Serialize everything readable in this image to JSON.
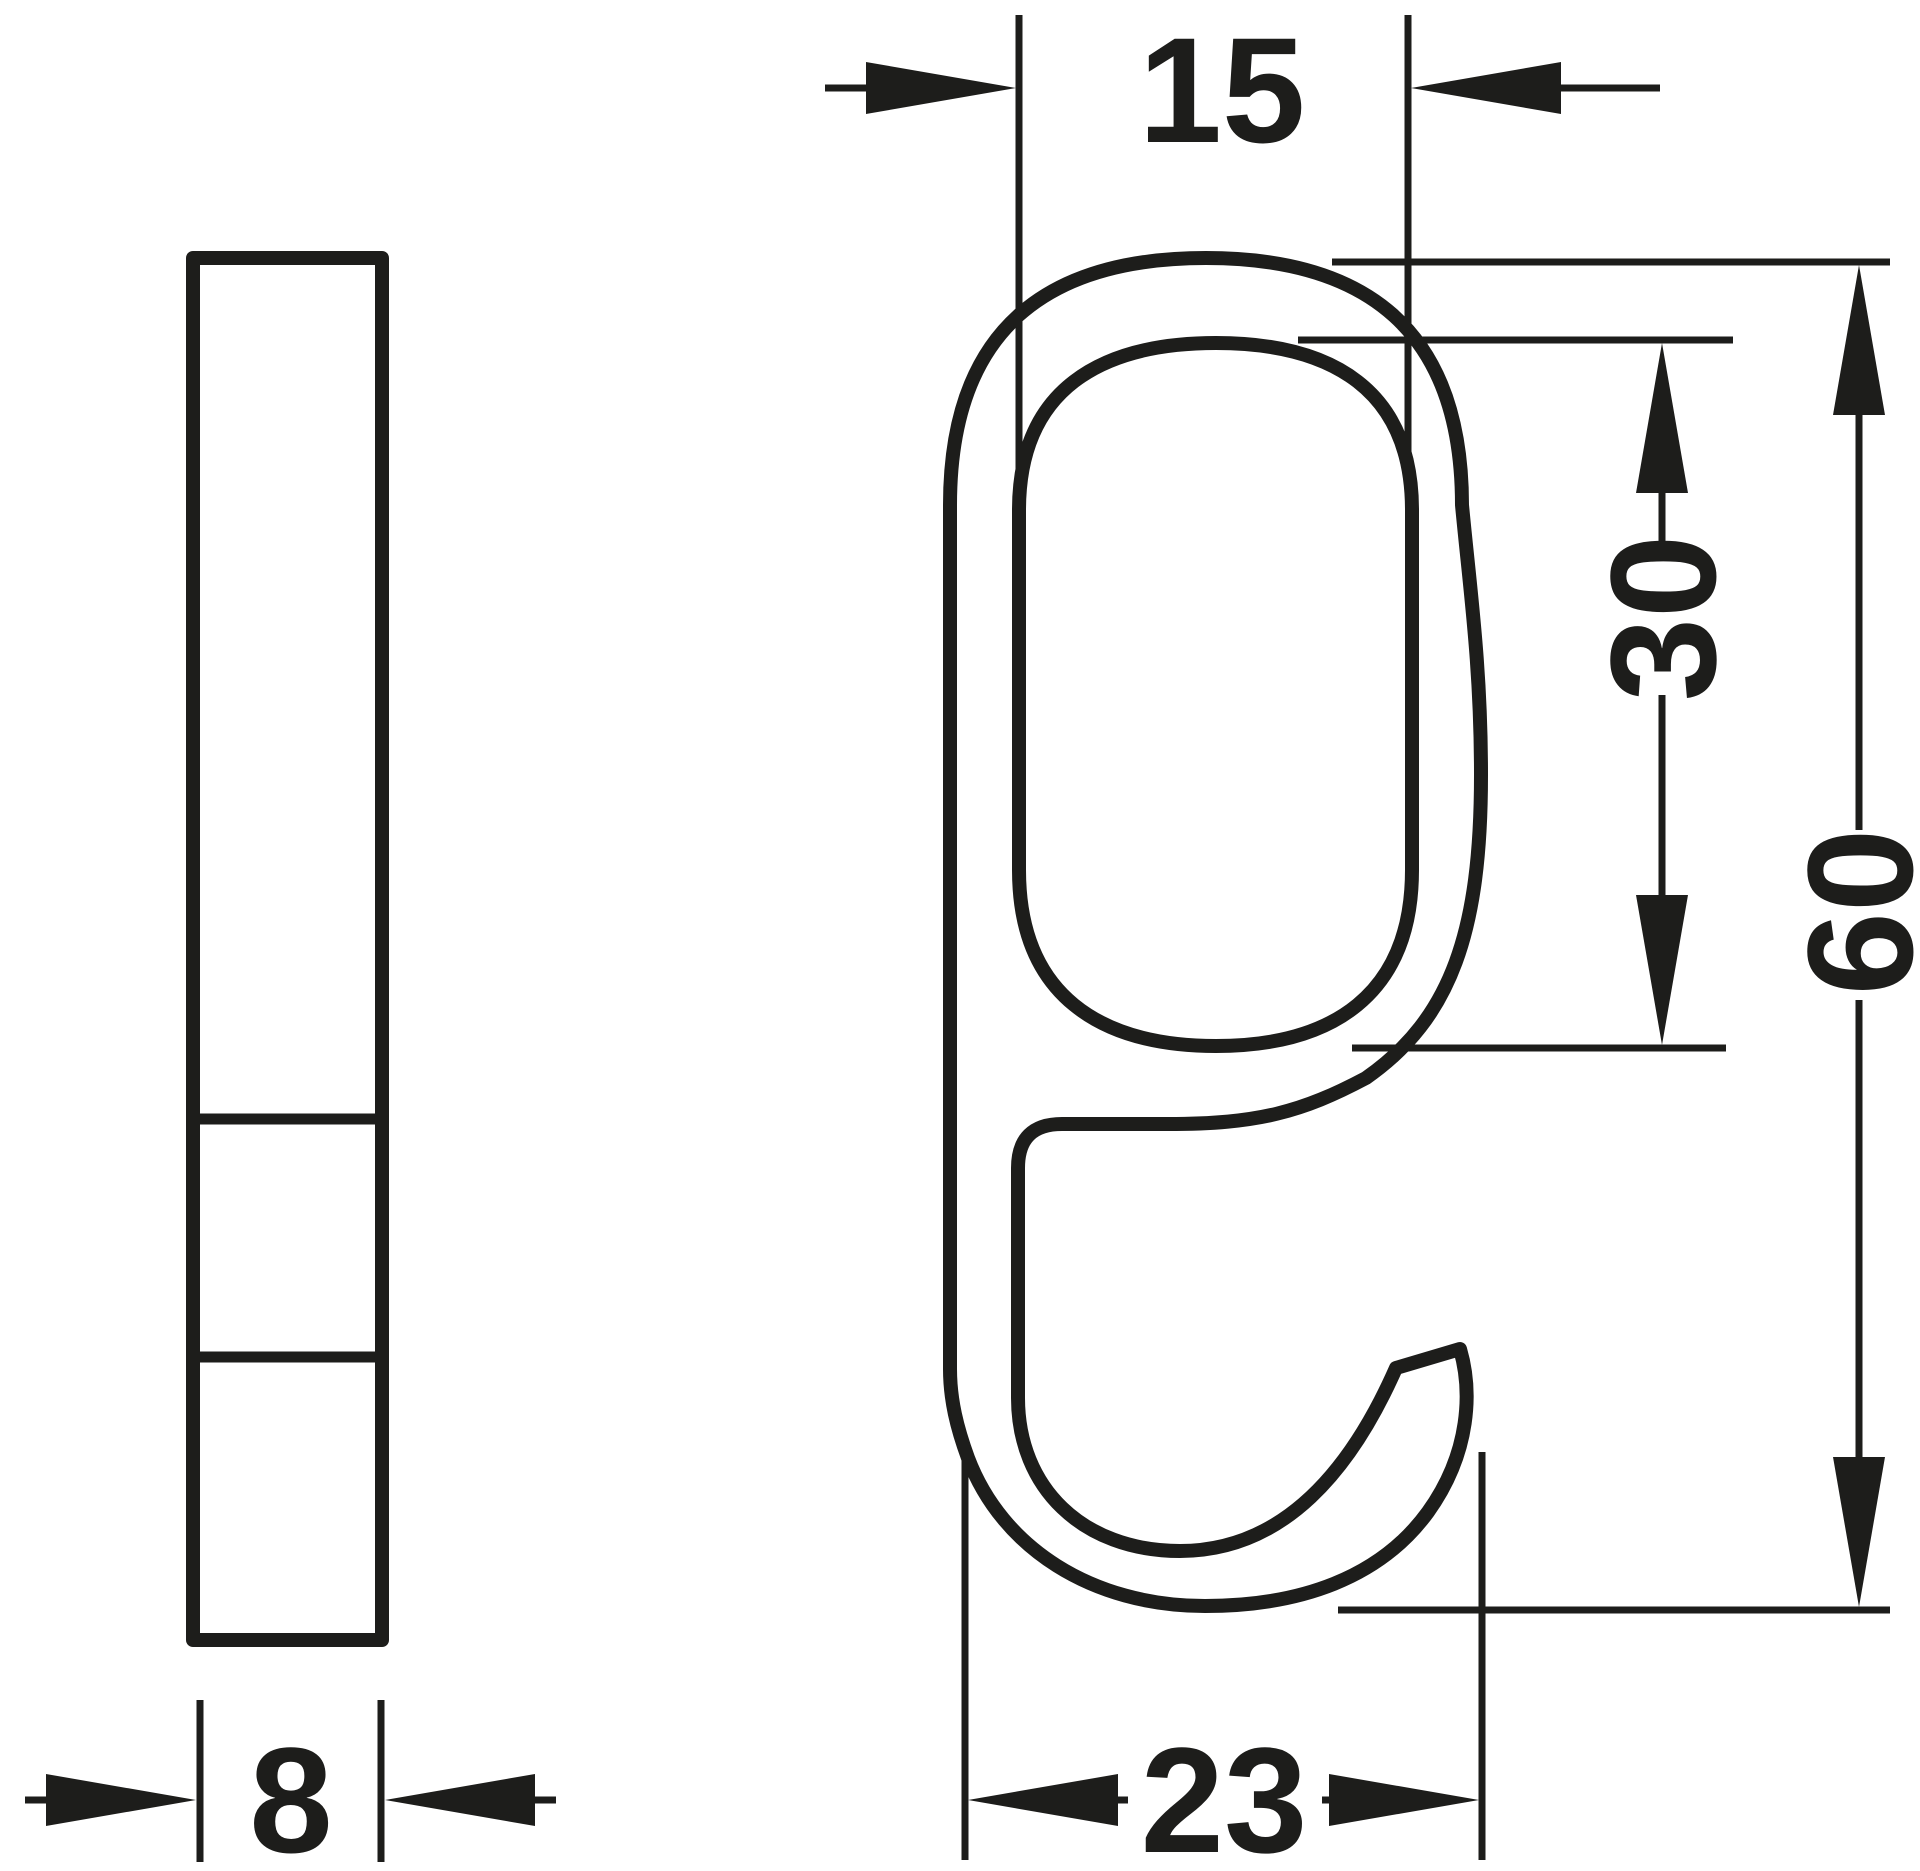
{
  "page": {
    "background": "#ffffff",
    "line_color": "#1d1d1b"
  },
  "drawing": {
    "type": "technical-dimension-drawing",
    "part": "wardrobe-rail-hook",
    "views": [
      {
        "id": "side-view",
        "description": "narrow side profile bar with two section lines"
      },
      {
        "id": "front-view",
        "description": "hook body with oval tube slot and lower C-hook"
      }
    ],
    "dimensions": {
      "slot_width": {
        "value": "15",
        "orientation": "horizontal",
        "position": "top"
      },
      "slot_height": {
        "value": "30",
        "orientation": "vertical",
        "position": "right-inner"
      },
      "total_height": {
        "value": "60",
        "orientation": "vertical",
        "position": "right-outer"
      },
      "hook_depth": {
        "value": "23",
        "orientation": "horizontal",
        "position": "bottom"
      },
      "thickness": {
        "value": "8",
        "orientation": "horizontal",
        "position": "bottom-left"
      }
    }
  }
}
